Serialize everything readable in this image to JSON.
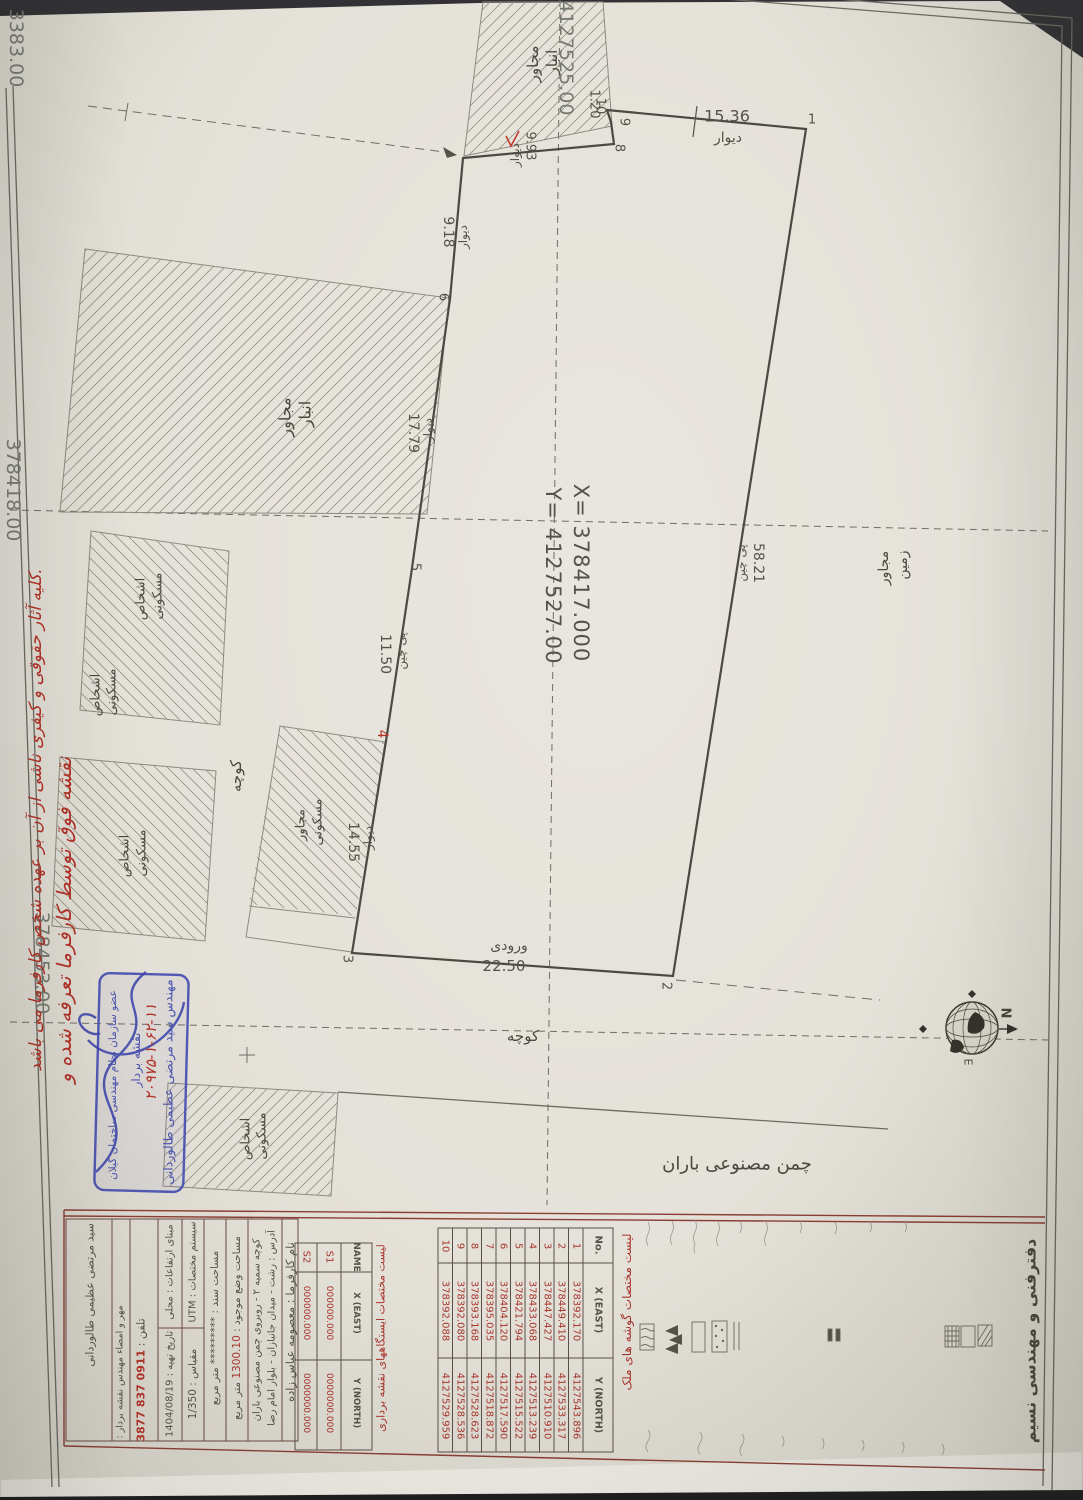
{
  "document": {
    "office_title": "دفترفنی و مهندسی نسیم",
    "grid_labels": {
      "top_left": "3383.00",
      "top_center": "4127525.00",
      "left_upper": "378418.00",
      "left_lower": "378453.00"
    },
    "center_marker": {
      "x": "X= 378417.000",
      "y": "Y= 4127527.00"
    },
    "compass": {
      "n": "N",
      "e": "E"
    }
  },
  "words": {
    "anbar": "انبار",
    "mojaver": "مجاور",
    "maskooni": "مسکونی",
    "ashkhas": "اشخاص",
    "zamin": "زمین",
    "koocheh": "کوچه",
    "turf": "چمن مصنوعی باران"
  },
  "parcel": {
    "vertices": {
      "v1": "1",
      "v2": "2",
      "v3": "3",
      "v4": "4",
      "v5": "5",
      "v6": "6",
      "v8": "8",
      "v9": "9",
      "v10": "10"
    },
    "dims": {
      "top": {
        "len": "15.36",
        "type": "دیوار"
      },
      "right": {
        "len": "58.21",
        "type": "پی چین"
      },
      "entrance": {
        "len": "22.50",
        "type": "ورودی"
      },
      "d3_4": {
        "len": "14.55",
        "type": "دیوار"
      },
      "d4_5": {
        "len": "11.50",
        "type": "پی چین"
      },
      "d5_6": {
        "len": "17.79",
        "type": "دیوار"
      },
      "d6_7": {
        "len": "9.18",
        "type": "دیوار"
      },
      "d7_8": {
        "len": "9.93",
        "type": "دیوار"
      },
      "d8_9": {
        "len": "1.20",
        "type": ""
      }
    }
  },
  "notes": {
    "red_line1": "نقشه فوق توسط کارفرما تعرفه شده و",
    "red_line2": "کلیه آثار حقوقی و کیفری ناشی از آن بر عهده شخص کارفرما می باشد.",
    "stamp_number": "۲۰۹۷۵-۱-۶۲-۱۱"
  },
  "stamp": {
    "line1": "مهندس سید مرتضی عظیمی طالوردانی",
    "line2": "نقشه بردار",
    "line3": "عضو سازمان نظام مهندسی ساختمان گیلان"
  },
  "tables": {
    "corners": {
      "caption": "لیست مختصات گوشه های ملک",
      "headers": [
        "No.",
        "X (EAST)",
        "Y (NORTH)"
      ],
      "rows": [
        [
          "1",
          "378392.170",
          "4127543.896"
        ],
        [
          "2",
          "378449.410",
          "4127533.317"
        ],
        [
          "3",
          "378447.427",
          "4127510.910"
        ],
        [
          "4",
          "378433.068",
          "4127513.239"
        ],
        [
          "5",
          "378421.794",
          "4127515.522"
        ],
        [
          "6",
          "378404.120",
          "4127517.590"
        ],
        [
          "7",
          "378395.035",
          "4127518.872"
        ],
        [
          "8",
          "378393.168",
          "4127528.623"
        ],
        [
          "9",
          "378392.080",
          "4127528.536"
        ],
        [
          "10",
          "378392.088",
          "4127529.959"
        ]
      ]
    },
    "stations": {
      "caption": "لیست مختصات ایستگاههای نقشه برداری",
      "headers": [
        "NAME",
        "X (EAST)",
        "Y (NORTH)"
      ],
      "rows": [
        [
          "S1",
          "000000.000",
          "0000000.000"
        ],
        [
          "S2",
          "000000.000",
          "0000000.000"
        ]
      ]
    }
  },
  "title_block": {
    "client_label": "نام کارفرما :",
    "client": "معصومه عباس زاده",
    "address_l1": "آدرس : رشت - میدان جانبازان - بلوار امام رضا",
    "address_l2": "کوچه سمیه ۲ - روبروی چمن مصنوعی باران",
    "area_label": "مساحت وضع موجود :",
    "area_value": "1300.10",
    "area_unit": "متر مربع",
    "deed_label": "مساحت سند :",
    "deed_value": "*********",
    "deed_unit": "متر مربع",
    "coord_sys": "سیستم مختصات : UTM",
    "scale_label": "مقیاس :",
    "scale_value": "1/350",
    "elev_basis": "مبنای ارتفاعات : محلی",
    "date_label": "تاریخ تهیه :",
    "date_value": "1404/08/19",
    "stamp_sign": "مهر و امضاء مهندس نقشه بردار :",
    "phone_label": "تلفن :",
    "phone_value": "0911 837 3877",
    "surveyor": "سید مرتضی عظیمی طالوردانی"
  }
}
